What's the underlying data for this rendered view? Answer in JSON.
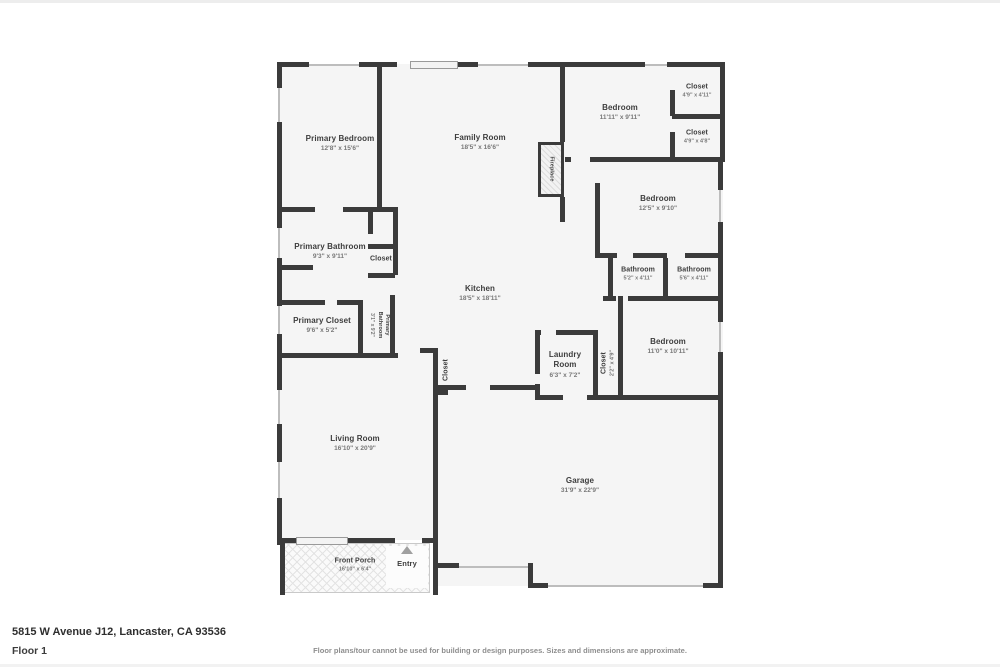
{
  "page": {
    "address": "5815 W Avenue J12, Lancaster, CA 93536",
    "floor_label": "Floor 1",
    "disclaimer": "Floor plans/tour cannot be used for building or design purposes. Sizes and dimensions are approximate."
  },
  "colors": {
    "wall": "#3b3b3b",
    "room_fill": "#f5f5f5",
    "room_name_text": "#3d3d3d",
    "dimension_text": "#787878"
  },
  "rooms": [
    {
      "id": "primary-bedroom",
      "name": "Primary Bedroom",
      "dims": "12'8\" x 15'6\""
    },
    {
      "id": "family-room",
      "name": "Family Room",
      "dims": "18'5\" x 16'6\""
    },
    {
      "id": "fireplace",
      "name": "Fireplace",
      "dims": ""
    },
    {
      "id": "bedroom-top",
      "name": "Bedroom",
      "dims": "11'11\" x 9'11\""
    },
    {
      "id": "closet-top-1",
      "name": "Closet",
      "dims": "4'9\" x 4'11\""
    },
    {
      "id": "closet-top-2",
      "name": "Closet",
      "dims": "4'9\" x 4'8\""
    },
    {
      "id": "bedroom-right",
      "name": "Bedroom",
      "dims": "12'5\" x 9'10\""
    },
    {
      "id": "primary-bathroom",
      "name": "Primary Bathroom",
      "dims": "9'3\" x 9'11\""
    },
    {
      "id": "closet-primary-bath",
      "name": "Closet",
      "dims": ""
    },
    {
      "id": "kitchen",
      "name": "Kitchen",
      "dims": "18'5\" x 18'11\""
    },
    {
      "id": "bathroom-1",
      "name": "Bathroom",
      "dims": "5'2\" x 4'11\""
    },
    {
      "id": "bathroom-2",
      "name": "Bathroom",
      "dims": "5'6\" x 4'11\""
    },
    {
      "id": "primary-closet",
      "name": "Primary Closet",
      "dims": "9'6\" x 5'2\""
    },
    {
      "id": "primary-bathroom-2",
      "name": "Primary Bathroom",
      "dims": "3'1\" x 9'2\""
    },
    {
      "id": "closet-kitchen",
      "name": "Closet",
      "dims": ""
    },
    {
      "id": "laundry-room",
      "name": "Laundry Room",
      "dims": "6'3\" x 7'2\""
    },
    {
      "id": "closet-laundry",
      "name": "Closet",
      "dims": "2'2\" x 4'9\""
    },
    {
      "id": "bedroom-back",
      "name": "Bedroom",
      "dims": "11'0\" x 10'11\""
    },
    {
      "id": "living-room",
      "name": "Living Room",
      "dims": "16'10\" x 20'9\""
    },
    {
      "id": "garage",
      "name": "Garage",
      "dims": "31'9\" x 22'9\""
    },
    {
      "id": "front-porch",
      "name": "Front Porch",
      "dims": "16'10\" x 6'4\""
    },
    {
      "id": "entry",
      "name": "Entry",
      "dims": ""
    }
  ]
}
